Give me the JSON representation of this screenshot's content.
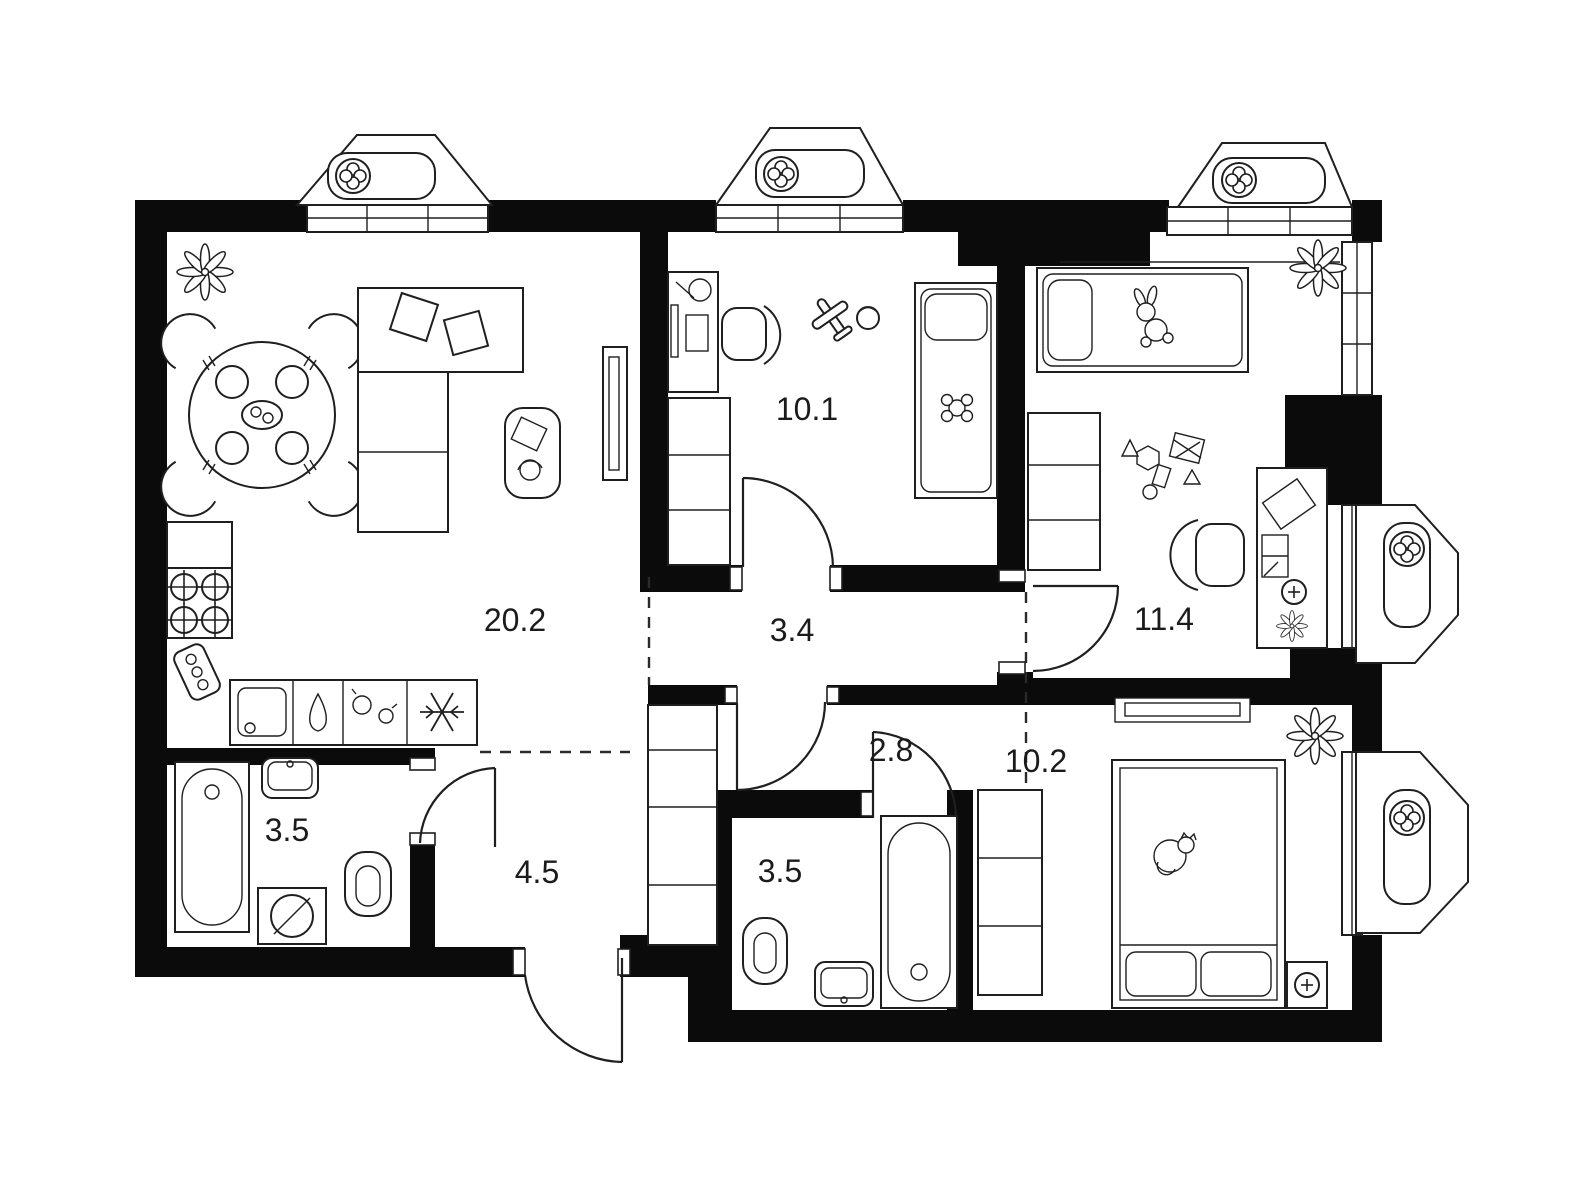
{
  "page": {
    "background": "#ffffff",
    "wall_color": "#0b0b0b",
    "line_color": "#1f1f1f"
  },
  "rooms": [
    {
      "id": "living-kitchen",
      "area_label": "20.2",
      "furniture": [
        "plant",
        "dining-table-with-4-chairs",
        "corner-sofa",
        "pillows",
        "tv-unit",
        "side-table",
        "kitchen-cabinet",
        "stove",
        "cutting-board",
        "kitchen-sink",
        "faucet",
        "jars",
        "fridge"
      ]
    },
    {
      "id": "kids-room-1",
      "area_label": "10.1",
      "furniture": [
        "desk",
        "desk-chair",
        "toy-plane",
        "ball",
        "single-bed",
        "plush-toy",
        "wardrobe"
      ]
    },
    {
      "id": "inner-hallway",
      "area_label": "3.4",
      "furniture": []
    },
    {
      "id": "kids-room-2",
      "area_label": "11.4",
      "furniture": [
        "single-bed",
        "bunny-toy",
        "plant",
        "toy-blocks",
        "wardrobe",
        "desk",
        "desk-chair",
        "desk-plant",
        "socket"
      ]
    },
    {
      "id": "corridor",
      "area_label": "2.8",
      "furniture": [
        "closet"
      ]
    },
    {
      "id": "bedroom",
      "area_label": "10.2",
      "furniture": [
        "double-bed",
        "cat",
        "pillows",
        "wardrobe",
        "bedside-table",
        "lamp",
        "plant",
        "wall-niche"
      ]
    },
    {
      "id": "bathroom-left",
      "area_label": "3.5",
      "furniture": [
        "bathtub",
        "sink",
        "toilet",
        "washing-machine"
      ]
    },
    {
      "id": "entry-hallway",
      "area_label": "4.5",
      "furniture": [
        "closet"
      ]
    },
    {
      "id": "bathroom-middle",
      "area_label": "3.5",
      "furniture": [
        "toilet",
        "sink",
        "bathtub"
      ]
    }
  ],
  "balconies": [
    {
      "id": "balcony-top-left",
      "icon": "ventilation-fan"
    },
    {
      "id": "balcony-top-middle",
      "icon": "ventilation-fan"
    },
    {
      "id": "balcony-top-right",
      "icon": "ventilation-fan"
    },
    {
      "id": "balcony-right-upper",
      "icon": "ventilation-fan"
    },
    {
      "id": "balcony-right-lower",
      "icon": "ventilation-fan"
    }
  ]
}
